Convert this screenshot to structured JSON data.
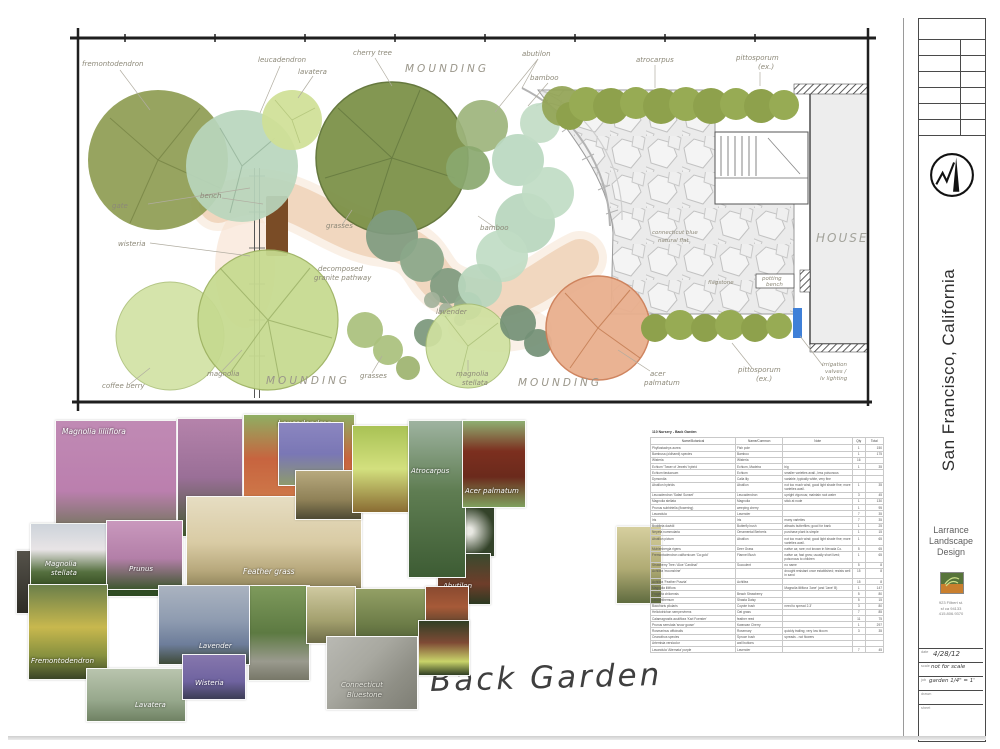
{
  "document": {
    "title": "Back Garden",
    "location": "San Francisco, California"
  },
  "plan": {
    "labels": {
      "fremontodendron": "fremontodendron",
      "leucadendron": "leucadendron",
      "lavatera": "lavatera",
      "cherry_tree": "cherry tree",
      "mounding_top": "MOUNDING",
      "abutilon": "abutilon",
      "bamboo_top": "bamboo",
      "atrocarpus": "atrocarpus",
      "pittosporum_top": "pittosporum",
      "pittosporum_top_ex": "(ex.)",
      "gate": "gate",
      "bench": "bench",
      "wisteria": "wisteria",
      "grasses_mid": "grasses",
      "decomposed": "decomposed",
      "granite_pathway": "granite pathway",
      "bamboo_mid": "bamboo",
      "lavender": "lavender",
      "conn_blue": "connecticut blue",
      "natural_flat": "natural flat",
      "house": "HOUSE",
      "potting": "potting",
      "bench2": "bench",
      "flagstone": "flagstone",
      "coffee_berry": "coffee berry",
      "magnolia": "magnolia",
      "mounding_bl": "MOUNDING",
      "grasses_bottom": "grasses",
      "magnolia2": "magnolia",
      "stellata": "stellata",
      "mounding_bc": "MOUNDING",
      "acer": "acer",
      "palmatum": "palmatum",
      "pittosporum_b": "pittosporum",
      "pittosporum_b_ex": "(ex.)",
      "irrigation": "irrigation",
      "valves": "valves /",
      "lv": "lv lighting"
    }
  },
  "collage": {
    "labels": {
      "magnolia_liliiflora": "Magnolia liliiflora",
      "leucadendron": "Leucadendron",
      "magnolia_stellata_1": "Magnolia",
      "magnolia_stellata_2": "stellata",
      "prunus": "Prunus",
      "feather_grass": "Feather grass",
      "fremontodendron": "Fremontodendron",
      "lavender": "Lavender",
      "wisteria": "Wisteria",
      "lavatera": "Lavatera",
      "atrocarpus": "Atrocarpus",
      "acer_palmatum": "Acer palmatum",
      "abutilon": "Abutilon",
      "bluestone_1": "Connecticut",
      "bluestone_2": "Bluestone"
    }
  },
  "schedule": {
    "title": "110 Nursery - Back Garden",
    "headers": [
      "Name/Botanical",
      "Name/Common",
      "Note",
      "Qty",
      "Total"
    ],
    "rows": [
      [
        "Phyllostachys aurea",
        "Fish pole",
        "",
        "1",
        "150"
      ],
      [
        "Bambusa (oldhamii) species",
        "Bamboo",
        "",
        "1",
        "175"
      ],
      [
        "Wisteria",
        "Wisteria",
        "",
        "16",
        ""
      ],
      [
        "Echium 'Tower of Jewels' hybrid",
        "Echium, Madeira",
        "big",
        "1",
        "35"
      ],
      [
        "Echium fastuosum",
        "Echium",
        "smaller varieties avail., less poisonous",
        "",
        ""
      ],
      [
        "Dymondia",
        "Calla lily",
        "variable, typically white, very fine",
        "",
        ""
      ],
      [
        "Abutilon hybrids",
        "Abutilon",
        "not too much wind, good light shade fine; more varieties avail.",
        "1",
        "35"
      ],
      [
        "Leucadendron 'Safari Sunset'",
        "Leucadendron",
        "upright vigorous; maintain root water",
        "3",
        "45"
      ],
      [
        "Magnolia stellata",
        "Magnolia",
        "stick at node",
        "1",
        "130"
      ],
      [
        "Prunus subhirtella (flowering)",
        "weeping cherry",
        "",
        "1",
        "95"
      ],
      [
        "Lavandula",
        "Lavender",
        "",
        "7",
        "35"
      ],
      [
        "Iris",
        "Iris",
        "many varieties",
        "7",
        "35"
      ],
      [
        "Buddleia davidii",
        "Butterfly bush",
        "attracts butterflies; good for bank",
        "1",
        "25"
      ],
      [
        "Nepeta nummularia",
        "Ornamental Berberis",
        "purchase plant is simple",
        "1",
        "15"
      ],
      [
        "Abutilon pictum",
        "Abutilon",
        "not too much wind; good light shade fine; more varieties avail.",
        "1",
        "65"
      ],
      [
        "Muhlenbergia rigens",
        "Deer Grass",
        "native ca; rare; not known in Nevada Co.",
        "5",
        "65"
      ],
      [
        "Fremontodendron californicum 'Ca gold'",
        "Flannel Bush",
        "native ca; fast grow; usually short lived; poisonous to children",
        "1",
        "65"
      ],
      [
        "Strawberry Tree / Aloe 'Cardinal'",
        "Succulent",
        "no name",
        "5",
        "8"
      ],
      [
        "Achillea 'moonshine'",
        "",
        "drought resistant once established; resists well in sand",
        "15",
        "8"
      ],
      [
        "Achillea 'Feather Puszta'",
        "Achillea",
        "",
        "15",
        "8"
      ],
      [
        "Magnolia liliiflora",
        "",
        "Magnolia liliiflora 'Jane' (and 'Jane' B)",
        "1",
        "147"
      ],
      [
        "Fragaria chiloensis",
        "Beach Strawberry",
        "",
        "5",
        "80"
      ],
      [
        "Leucanthemum",
        "Shasta Daisy",
        "",
        "5",
        "15"
      ],
      [
        "Baccharis pilularis",
        "Coyote bush",
        "need to spread 2-3'",
        "3",
        "80"
      ],
      [
        "Helictotrichon sempervirens",
        "Oat grass",
        "",
        "7",
        "85"
      ],
      [
        "Calamagrostis acutiflora 'Karl Foerster'",
        "feather reed",
        "",
        "11",
        "75"
      ],
      [
        "Prunus serrulata 'snow goose'",
        "Kwanzan Cherry",
        "",
        "1",
        "297"
      ],
      [
        "Rosmarinus officinalis",
        "Rosemary",
        "quickly trailing; very low bloom",
        "3",
        "35"
      ],
      [
        "Ceanothus species",
        "Spruce bush",
        "spreads - not flowers",
        "",
        ""
      ],
      [
        "Artemisia versicolor",
        "wall buttons",
        "",
        "",
        ""
      ],
      [
        "Lavandula 'Alternata' purple",
        "Lavender",
        "",
        "7",
        "45"
      ]
    ]
  },
  "titleblock": {
    "location": "San Francisco, California",
    "firm_line1": "Larrance",
    "firm_line2": "Landscape",
    "firm_line3": "Design",
    "addr_line1": "923 Filbert st.",
    "addr_line2": "sf ca 94133",
    "addr_line3": "415.806.9370",
    "date_label": "date",
    "date_value": "4/28/12",
    "scale_label": "scale",
    "scale_value": "not for scale",
    "job_label": "job",
    "job_value": "garden 1/4\" = 1'",
    "drawn_label": "drawn",
    "sheet_label": "sheet",
    "of_label": "of",
    "sheets_label": "sheets"
  },
  "colors": {
    "olive_tree": "#8e9c52",
    "mint_tree": "#b9d6bd",
    "light_green": "#c6da90",
    "acer_peach": "#e9af8e",
    "path_tan": "#f0d4ba",
    "flagstone_gray": "#ebebeb",
    "valve_blue": "#3f80d8"
  }
}
